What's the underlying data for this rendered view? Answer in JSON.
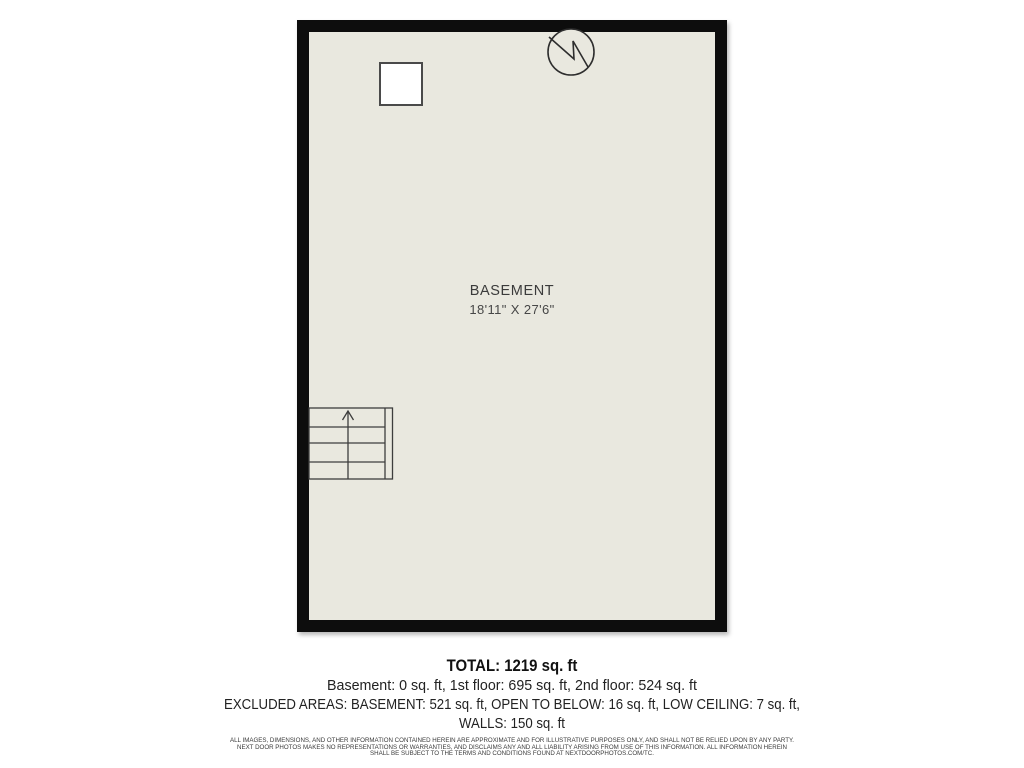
{
  "floorplan": {
    "room_label": "BASEMENT",
    "room_dimensions": "18'11\" X 27'6\"",
    "colors": {
      "floor": "#e9e8df",
      "wall": "#0d0d0d",
      "line": "#3d3d3d"
    },
    "symbols": [
      "window-square",
      "water-heater-circle-zigzag",
      "staircase-with-up-arrow"
    ]
  },
  "summary": {
    "total": "TOTAL: 1219 sq. ft",
    "floors": "Basement: 0 sq. ft, 1st floor: 695 sq. ft, 2nd floor: 524 sq. ft",
    "excluded_line1": "EXCLUDED AREAS: BASEMENT: 521 sq. ft, OPEN TO BELOW: 16 sq. ft, LOW CEILING: 7 sq. ft,",
    "excluded_line2": "WALLS: 150 sq. ft"
  },
  "disclaimer": {
    "line1": "ALL IMAGES, DIMENSIONS, AND OTHER INFORMATION CONTAINED HEREIN ARE APPROXIMATE AND FOR ILLUSTRATIVE PURPOSES ONLY, AND SHALL NOT BE RELIED UPON BY ANY PARTY.",
    "line2": "NEXT DOOR PHOTOS MAKES NO REPRESENTATIONS OR WARRANTIES, AND DISCLAIMS ANY AND ALL LIABILITY ARISING FROM USE OF THIS INFORMATION. ALL INFORMATION HEREIN",
    "line3": "SHALL BE SUBJECT TO THE TERMS AND CONDITIONS FOUND AT NEXTDOORPHOTOS.COM/TC."
  }
}
